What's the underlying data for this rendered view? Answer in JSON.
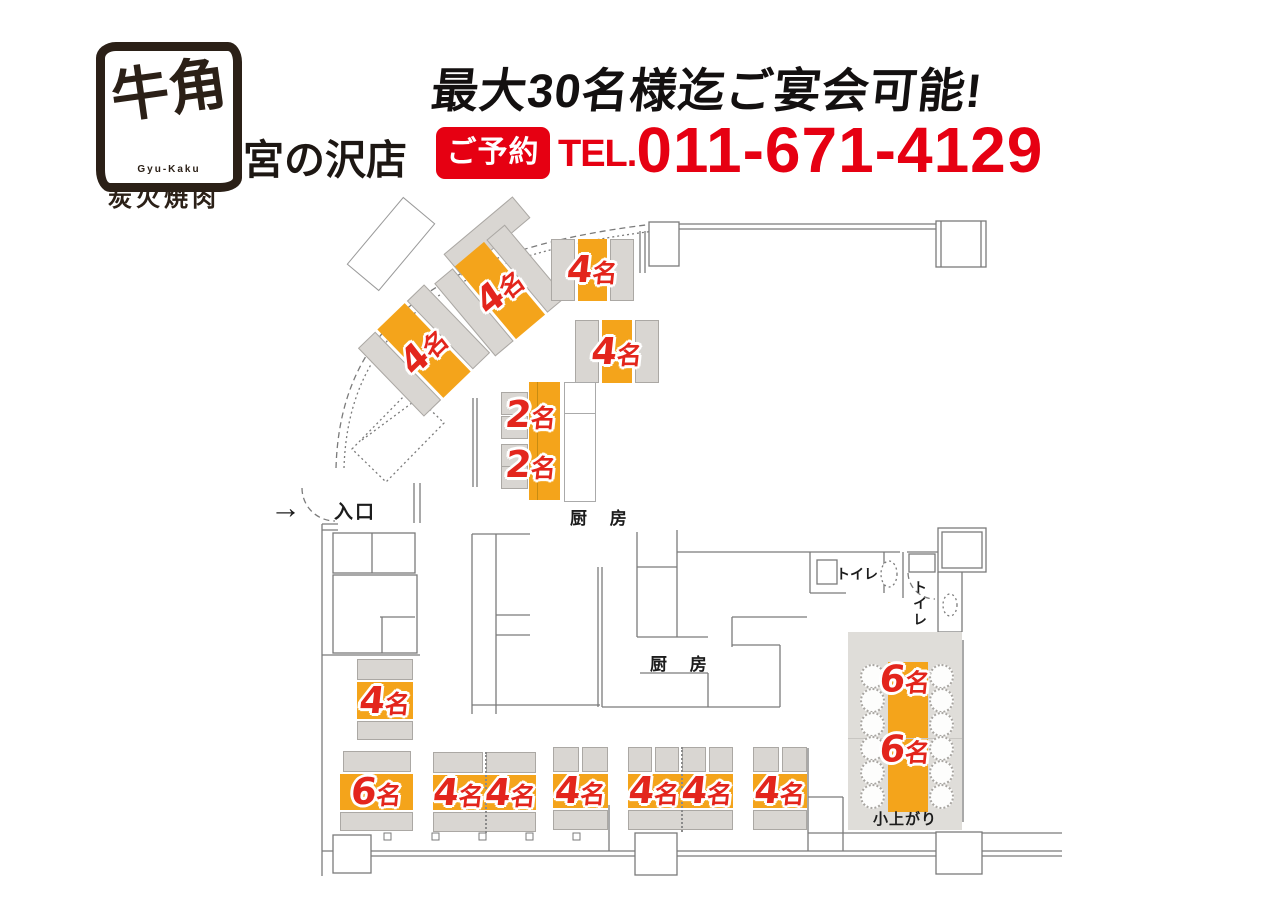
{
  "header": {
    "logo_main": "牛角",
    "logo_romaji": "Gyu-Kaku",
    "logo_sub": "炭火焼肉",
    "store_name": "宮の沢店",
    "banner": "最大30名様迄ご宴会可能!",
    "reserve_badge": "ご予約",
    "tel_prefix": "TEL.",
    "tel_number": "011-671-4129"
  },
  "floorplan": {
    "entrance_arrow": "→",
    "entrance": "入口",
    "kitchen_upper": "厨 房",
    "kitchen_lower": "厨 房",
    "toilet_a": "トイレ",
    "toilet_b": "トイレ",
    "tatami_name": "小上がり",
    "tables": [
      {
        "id": "curve-1",
        "label": "4名"
      },
      {
        "id": "curve-2",
        "label": "4名"
      },
      {
        "id": "top-1",
        "label": "4名"
      },
      {
        "id": "top-2",
        "label": "4名"
      },
      {
        "id": "counter-1",
        "label": "2名"
      },
      {
        "id": "counter-2",
        "label": "2名"
      },
      {
        "id": "west-1",
        "label": "4名"
      },
      {
        "id": "south-1",
        "label": "6名"
      },
      {
        "id": "south-2",
        "label": "4名"
      },
      {
        "id": "south-3",
        "label": "4名"
      },
      {
        "id": "south-4",
        "label": "4名"
      },
      {
        "id": "south-5",
        "label": "4名"
      },
      {
        "id": "south-6",
        "label": "4名"
      },
      {
        "id": "south-7",
        "label": "4名"
      },
      {
        "id": "tatami-1",
        "label": "6名"
      },
      {
        "id": "tatami-2",
        "label": "6名"
      }
    ],
    "colors": {
      "table_orange": "#F4A41B",
      "bench_gray": "#D9D6D2",
      "label_red": "#E3251C",
      "accent_red": "#E60012",
      "wall_gray": "#7B7B7B"
    }
  }
}
